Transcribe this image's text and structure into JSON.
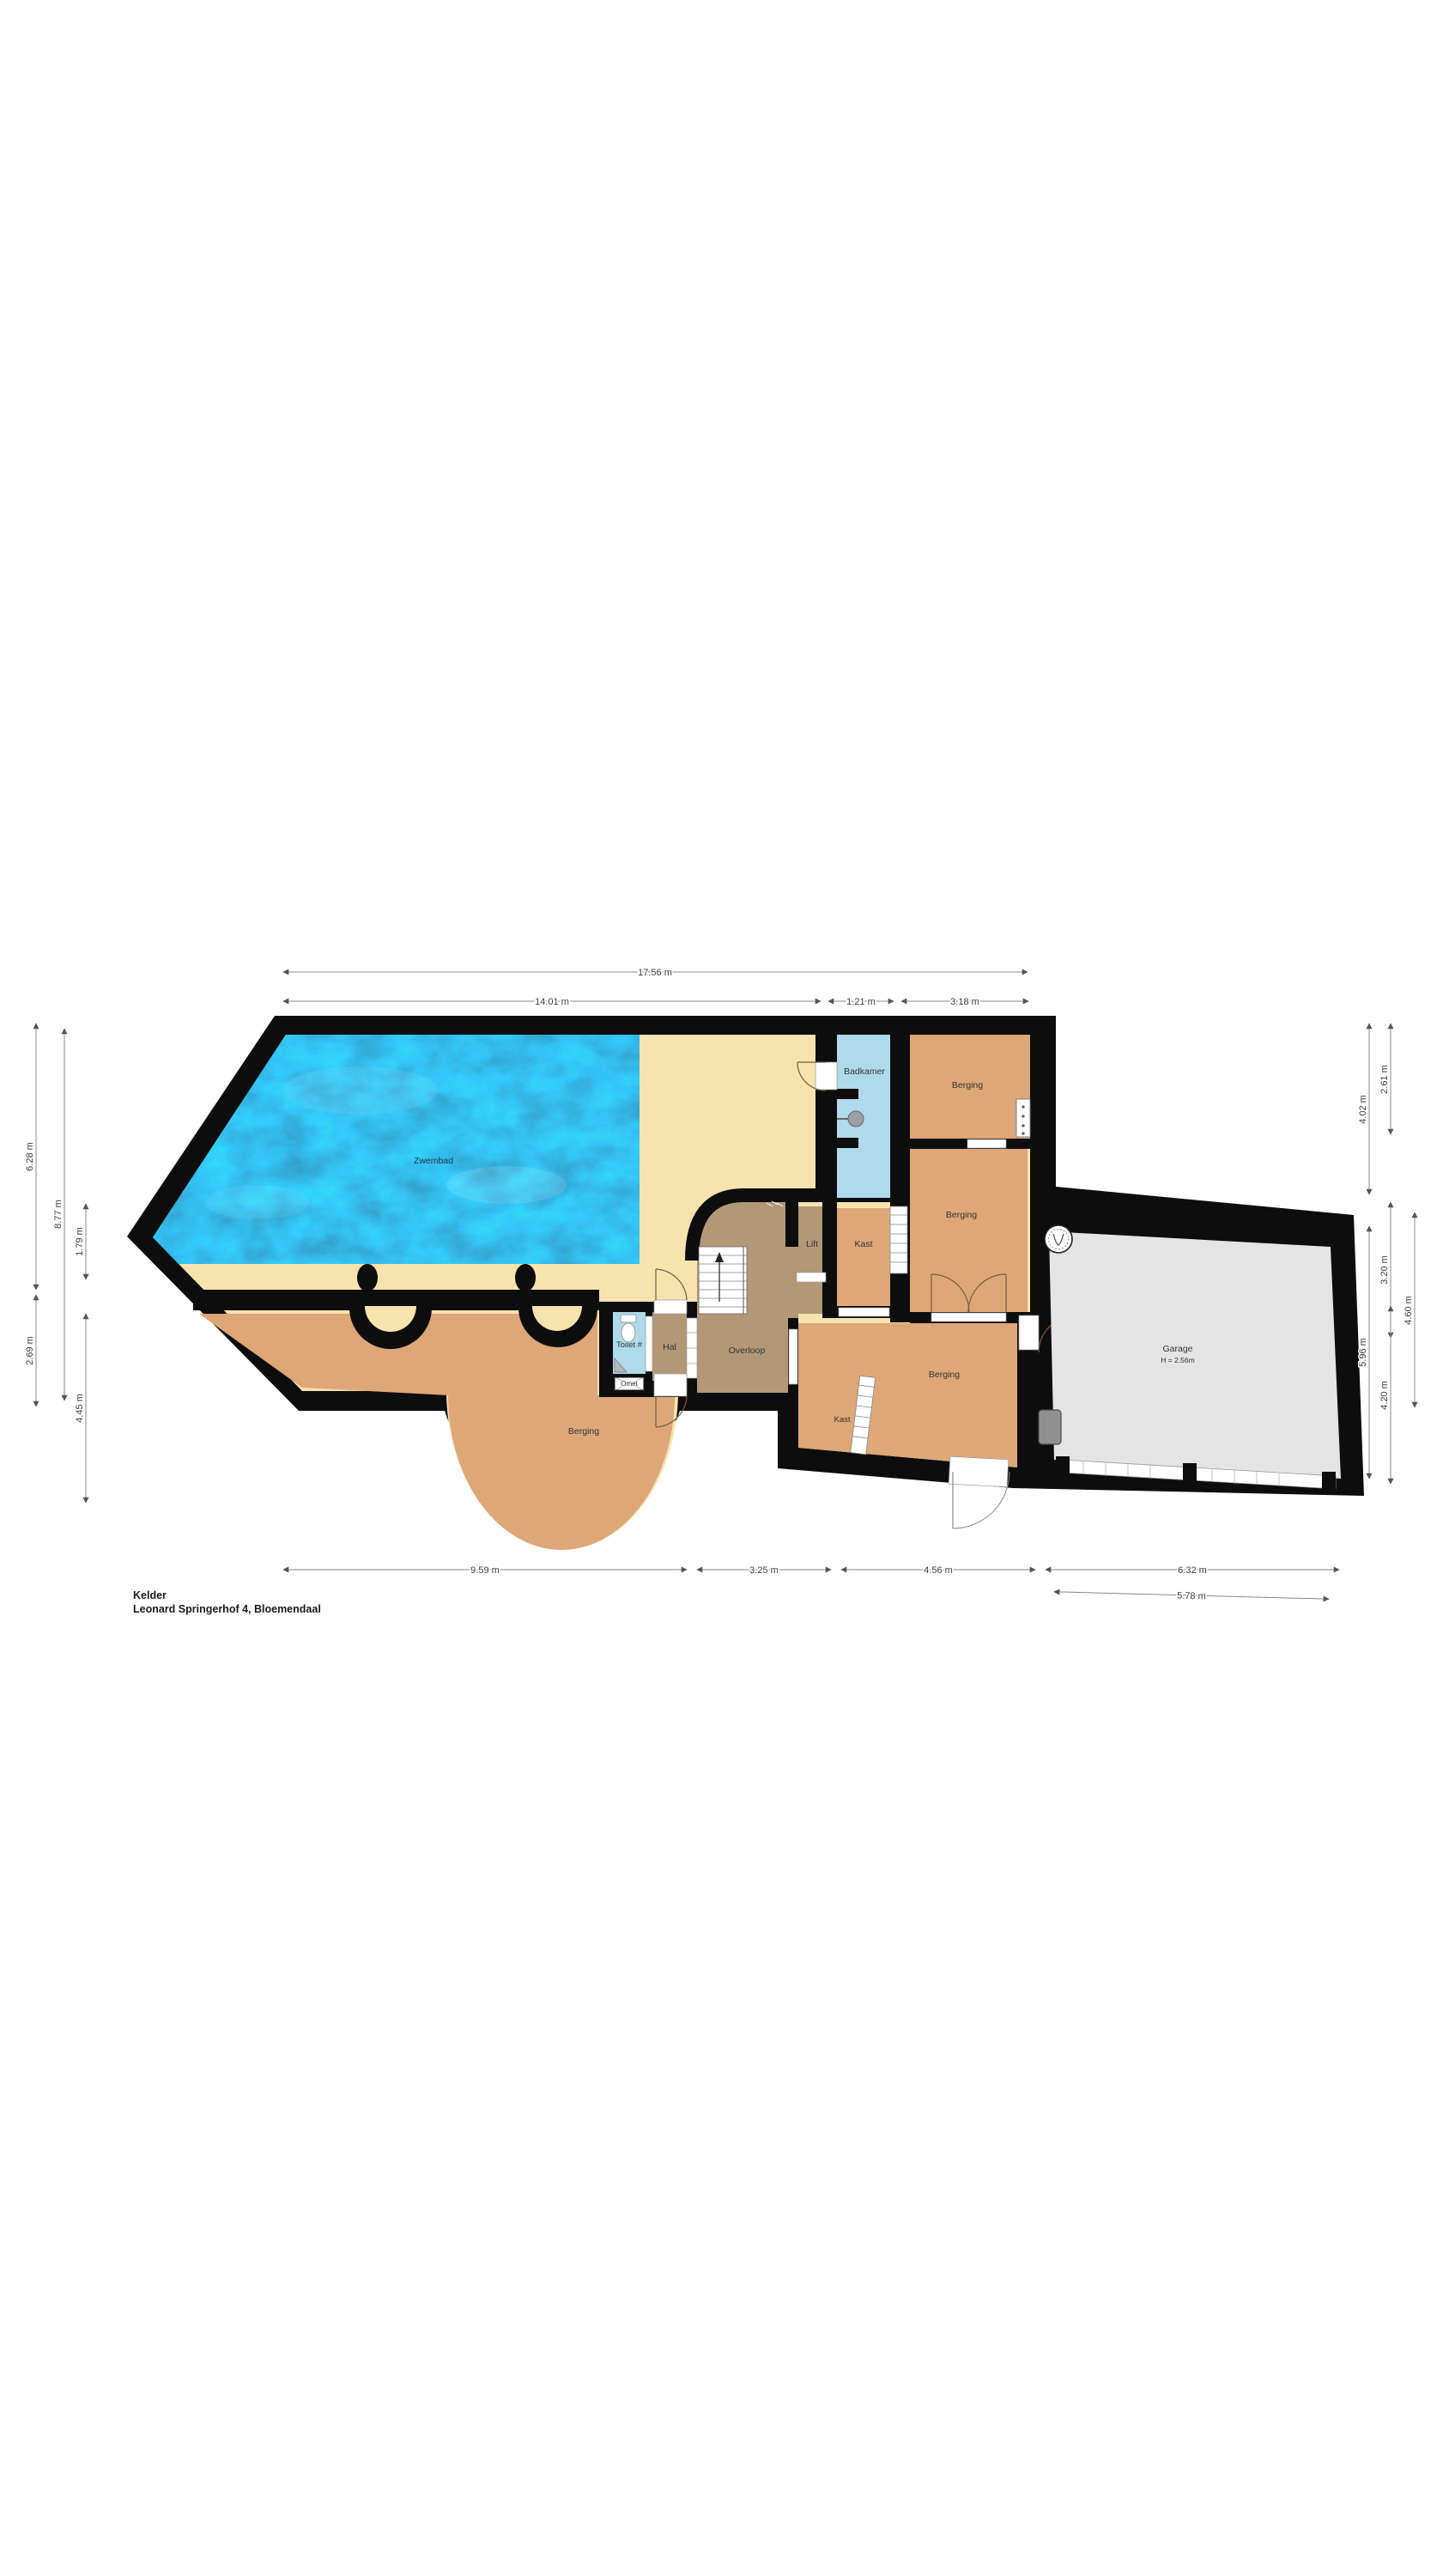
{
  "title": {
    "floor": "Kelder",
    "address": "Leonard Springerhof 4, Bloemendaal"
  },
  "rooms": {
    "pool": "Zwembad",
    "bathroom": "Badkamer",
    "storage_top_right": "Berging",
    "storage_middle": "Berging",
    "lift": "Lift",
    "closet_top": "Kast",
    "toilet": "Toilet #",
    "hall": "Hal",
    "landing": "Overloop",
    "storage_bottom": "Berging",
    "closet_bottom": "Kast",
    "storage_left": "Berging",
    "garage": "Garage",
    "garage_height": "H = 2.56m",
    "fixture_box": "Omet"
  },
  "dimensions": {
    "total_width": "17.56 m",
    "pool_width": "14.01 m",
    "bath_width": "1.21 m",
    "storage_width": "3.18 m",
    "left_outer_top": "6.28 m",
    "left_outer_bottom": "2.69 m",
    "left_mid": "8.77 m",
    "left_inner_top": "1.79 m",
    "left_inner_bottom": "4.45 m",
    "right_inner_top": "4.02 m",
    "right_inner_bottom": "5.96 m",
    "right_mid_top": "2.61 m",
    "right_mid_middle": "3.20 m",
    "right_mid_bottom": "4.20 m",
    "right_outer": "4.60 m",
    "bottom_left": "9.59 m",
    "bottom_center": "3.25 m",
    "bottom_right": "4.56 m",
    "bottom_garage": "6.32 m",
    "bottom_garage_inner": "5.78 m"
  },
  "colors": {
    "wall": "#0d0d0d",
    "pool_water": "#1286bd",
    "deck": "#f6e3ae",
    "storage_tan": "#dda778",
    "circulation_taupe": "#b29877",
    "wet_room_blue": "#aedaeb",
    "garage_gray": "#e4e4e4",
    "dimension_gray": "#8a8a8a"
  }
}
